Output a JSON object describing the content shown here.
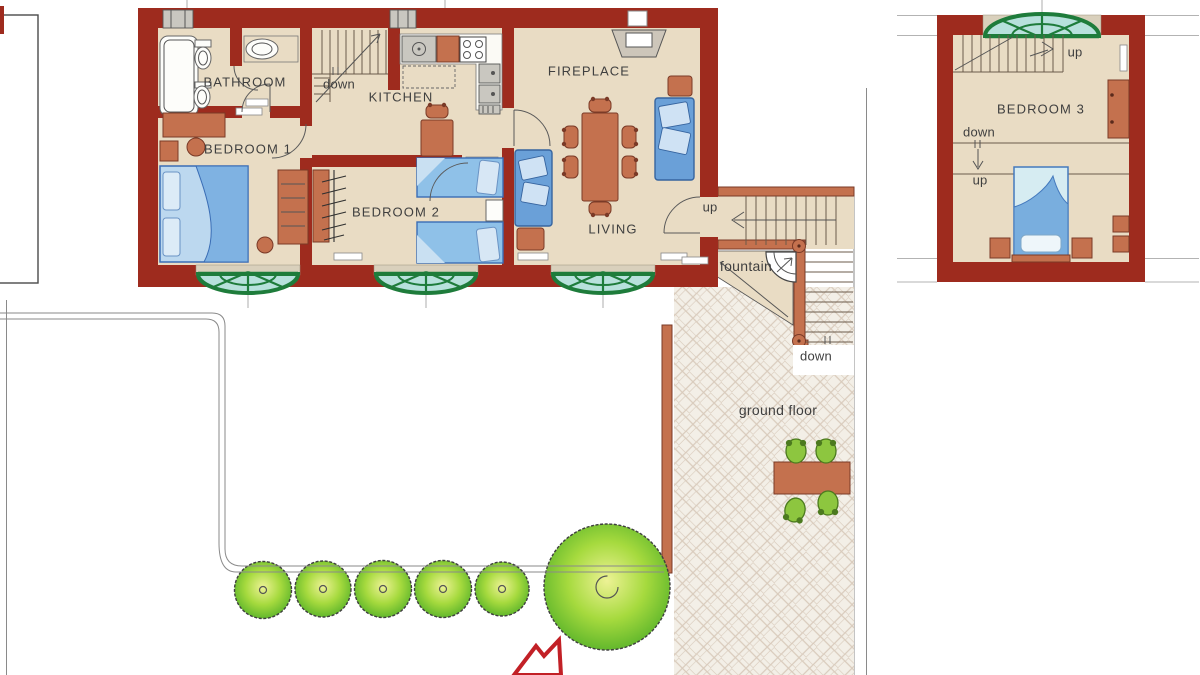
{
  "plan_labels": {
    "bathroom": "BATHROOM",
    "bedroom1": "BEDROOM 1",
    "kitchen": "KITCHEN",
    "bedroom2": "BEDROOM 2",
    "fireplace": "FIREPLACE",
    "living": "LIVING",
    "bedroom3": "BEDROOM 3"
  },
  "annotations": {
    "stairs_down_interior": "down",
    "stairs_up_exterior": "up",
    "stairs_down_exterior": "down",
    "fountain": "fountain",
    "ground_floor": "ground floor",
    "b3_stairs_up_top": "up",
    "b3_down": "down",
    "b3_up": "up"
  },
  "colors": {
    "wall": "#9e2b1e",
    "accent_terracotta": "#c4714e",
    "floor": "#e9dcc4",
    "sill": "#d9d0bc",
    "window_green": "#1e7c3b",
    "window_glass": "#b7e1dc",
    "furniture_blue": "#6aa0d8",
    "furniture_blue_dark": "#36649f",
    "cushion_blue": "#cfe2f4",
    "patio_bg": "#f3efe7",
    "patio_line": "#d9cbbc",
    "chair_green": "#8dc63f",
    "arrow_red": "#c22026",
    "text": "#3f3f3f"
  }
}
